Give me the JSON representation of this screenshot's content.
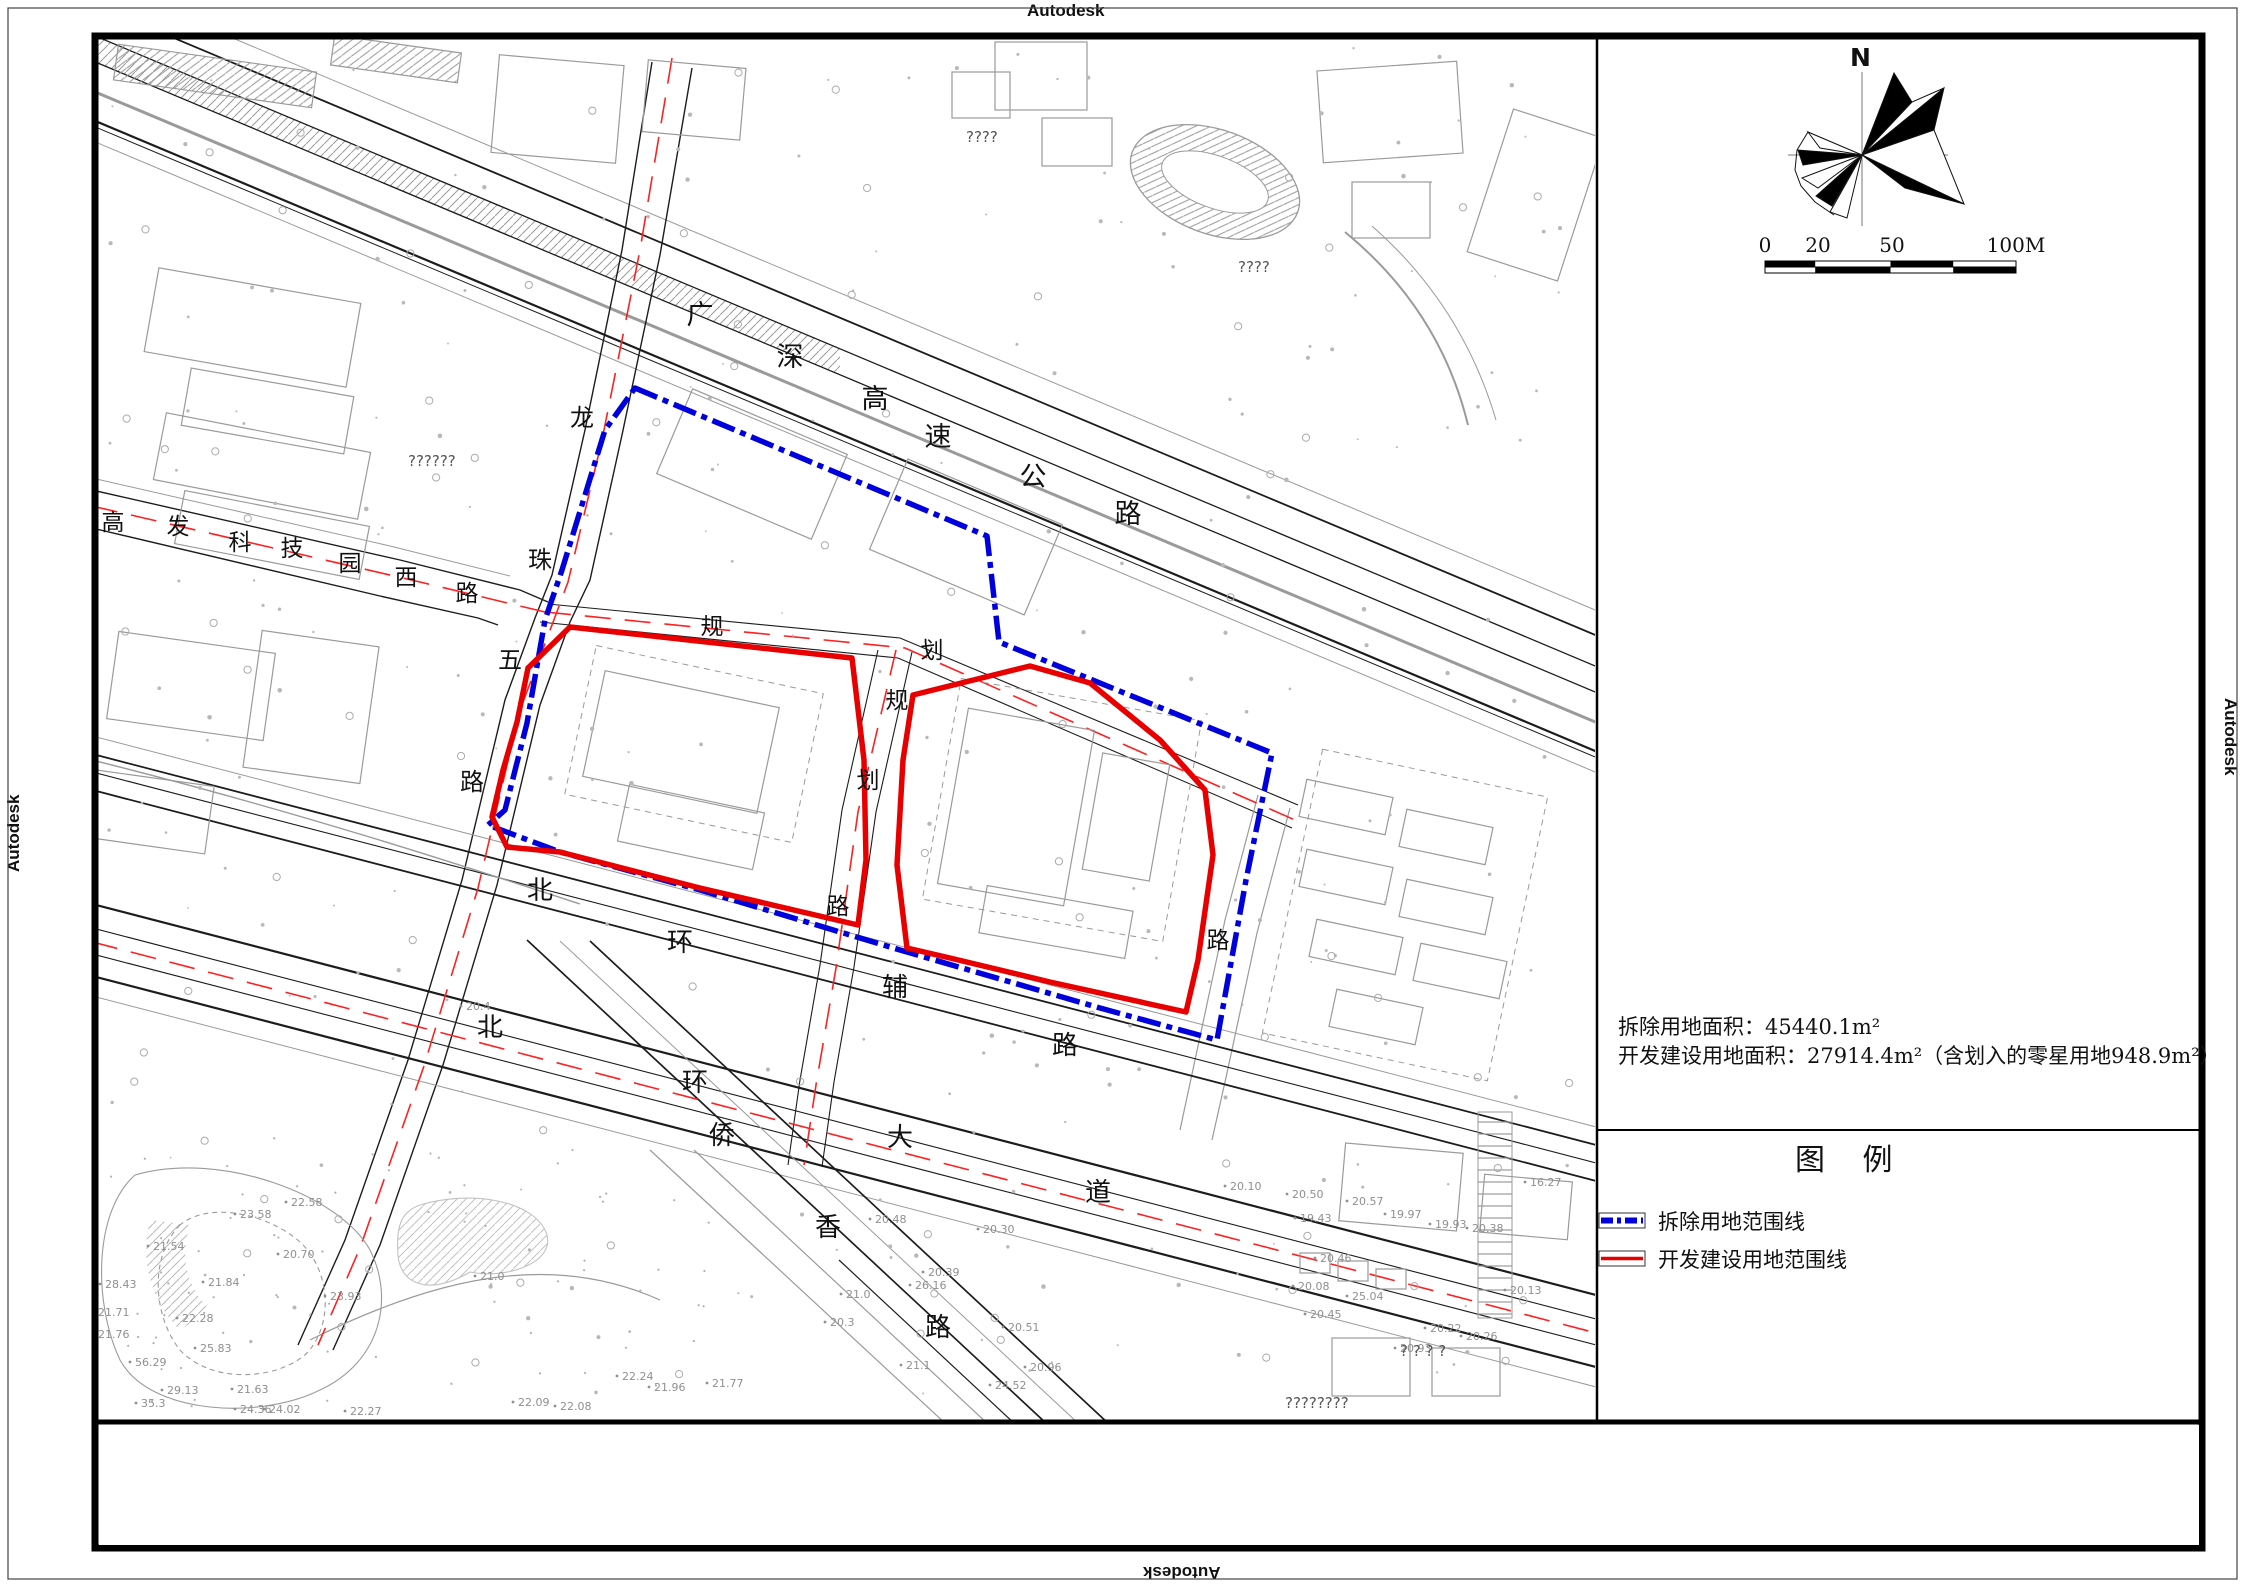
{
  "watermarks": {
    "top": "Autodesk",
    "bottom": "Autodesk",
    "left": "Autodesk",
    "right": "Autodesk"
  },
  "colors": {
    "demolition_blue": "#0000dd",
    "development_red": "#e80000",
    "centerline_red": "#ff2020",
    "road_dark": "#1c1c1c",
    "road_gray": "#9a9a9a"
  },
  "north_label": "N",
  "scale_bar": {
    "labels": [
      "0",
      "20",
      "50",
      "100M"
    ]
  },
  "notes": {
    "line1": "拆除用地面积：45440.1m²",
    "line2": "开发建设用地面积：27914.4m²（含划入的零星用地948.9m²）"
  },
  "legend": {
    "title": "图 例",
    "items": [
      {
        "label": "拆除用地范围线",
        "type": "demolition"
      },
      {
        "label": "开发建设用地范围线",
        "type": "development"
      }
    ]
  },
  "roads": [
    {
      "name": "广深高速公路",
      "size": 27,
      "chars": [
        {
          "t": "广",
          "x": 700,
          "y": 324
        },
        {
          "t": "深",
          "x": 790,
          "y": 366
        },
        {
          "t": "高",
          "x": 875,
          "y": 408
        },
        {
          "t": "速",
          "x": 938,
          "y": 446
        },
        {
          "t": "公",
          "x": 1033,
          "y": 486
        },
        {
          "t": "路",
          "x": 1128,
          "y": 523
        }
      ]
    },
    {
      "name": "高发科技园西路",
      "size": 23,
      "chars": [
        {
          "t": "高",
          "x": 113,
          "y": 530
        },
        {
          "t": "发",
          "x": 178,
          "y": 534
        },
        {
          "t": "科",
          "x": 240,
          "y": 550
        },
        {
          "t": "技",
          "x": 292,
          "y": 556
        },
        {
          "t": "园",
          "x": 350,
          "y": 571
        },
        {
          "t": "西",
          "x": 406,
          "y": 585
        },
        {
          "t": "路",
          "x": 467,
          "y": 601
        }
      ]
    },
    {
      "name": "龙珠五路",
      "size": 24,
      "chars": [
        {
          "t": "龙",
          "x": 582,
          "y": 426
        },
        {
          "t": "珠",
          "x": 540,
          "y": 568
        },
        {
          "t": "五",
          "x": 510,
          "y": 668
        },
        {
          "t": "路",
          "x": 472,
          "y": 790
        }
      ]
    },
    {
      "name": "规划",
      "size": 23,
      "chars": [
        {
          "t": "规",
          "x": 712,
          "y": 634
        },
        {
          "t": "划",
          "x": 932,
          "y": 658
        }
      ]
    },
    {
      "name": "规划路",
      "size": 23,
      "chars": [
        {
          "t": "规",
          "x": 897,
          "y": 708
        },
        {
          "t": "划",
          "x": 868,
          "y": 788
        },
        {
          "t": "路",
          "x": 838,
          "y": 914
        }
      ]
    },
    {
      "name": "路",
      "size": 23,
      "chars": [
        {
          "t": "路",
          "x": 1218,
          "y": 948
        }
      ]
    },
    {
      "name": "北环辅路",
      "size": 26,
      "chars": [
        {
          "t": "北",
          "x": 540,
          "y": 899
        },
        {
          "t": "环",
          "x": 680,
          "y": 951
        },
        {
          "t": "辅",
          "x": 895,
          "y": 996
        },
        {
          "t": "路",
          "x": 1065,
          "y": 1054
        }
      ]
    },
    {
      "name": "北环大道",
      "size": 26,
      "chars": [
        {
          "t": "北",
          "x": 490,
          "y": 1036
        },
        {
          "t": "环",
          "x": 695,
          "y": 1091
        },
        {
          "t": "大",
          "x": 900,
          "y": 1146
        },
        {
          "t": "道",
          "x": 1098,
          "y": 1201
        }
      ]
    },
    {
      "name": "侨香路",
      "size": 26,
      "chars": [
        {
          "t": "侨",
          "x": 722,
          "y": 1144
        },
        {
          "t": "香",
          "x": 828,
          "y": 1236
        },
        {
          "t": "路",
          "x": 938,
          "y": 1336
        }
      ]
    }
  ],
  "spot_elevations": [
    {
      "v": "20.48",
      "x": 875,
      "y": 1223
    },
    {
      "v": "20.30",
      "x": 983,
      "y": 1233
    },
    {
      "v": "20.39",
      "x": 928,
      "y": 1276
    },
    {
      "v": "26.16",
      "x": 915,
      "y": 1289
    },
    {
      "v": "21.0",
      "x": 846,
      "y": 1298
    },
    {
      "v": "20.51",
      "x": 1008,
      "y": 1331
    },
    {
      "v": "20.96",
      "x": 1030,
      "y": 1371
    },
    {
      "v": "24.52",
      "x": 995,
      "y": 1389
    },
    {
      "v": "21.1",
      "x": 906,
      "y": 1369
    },
    {
      "v": "20.3",
      "x": 830,
      "y": 1326
    },
    {
      "v": "29.13",
      "x": 167,
      "y": 1394
    },
    {
      "v": "35.3",
      "x": 141,
      "y": 1407
    },
    {
      "v": "21.63",
      "x": 237,
      "y": 1393
    },
    {
      "v": "24.36",
      "x": 240,
      "y": 1413
    },
    {
      "v": "24.02",
      "x": 269,
      "y": 1413
    },
    {
      "v": "22.27",
      "x": 350,
      "y": 1415
    },
    {
      "v": "22.09",
      "x": 518,
      "y": 1406
    },
    {
      "v": "22.08",
      "x": 560,
      "y": 1410
    },
    {
      "v": "21.96",
      "x": 654,
      "y": 1391
    },
    {
      "v": "21.77",
      "x": 712,
      "y": 1387
    },
    {
      "v": "22.24",
      "x": 622,
      "y": 1380
    },
    {
      "v": "23.58",
      "x": 240,
      "y": 1218
    },
    {
      "v": "22.58",
      "x": 291,
      "y": 1206
    },
    {
      "v": "21.54",
      "x": 153,
      "y": 1250
    },
    {
      "v": "20.70",
      "x": 283,
      "y": 1258
    },
    {
      "v": "21.84",
      "x": 208,
      "y": 1286
    },
    {
      "v": "28.43",
      "x": 105,
      "y": 1288
    },
    {
      "v": "21.71",
      "x": 98,
      "y": 1316
    },
    {
      "v": "22.28",
      "x": 182,
      "y": 1322
    },
    {
      "v": "21.76",
      "x": 98,
      "y": 1338
    },
    {
      "v": "25.83",
      "x": 200,
      "y": 1352
    },
    {
      "v": "56.29",
      "x": 135,
      "y": 1366
    },
    {
      "v": "23.93",
      "x": 330,
      "y": 1300
    },
    {
      "v": "20.10",
      "x": 1230,
      "y": 1190
    },
    {
      "v": "20.50",
      "x": 1292,
      "y": 1198
    },
    {
      "v": "20.57",
      "x": 1352,
      "y": 1205
    },
    {
      "v": "19.43",
      "x": 1300,
      "y": 1222
    },
    {
      "v": "19.97",
      "x": 1390,
      "y": 1218
    },
    {
      "v": "19.93",
      "x": 1435,
      "y": 1228
    },
    {
      "v": "20.38",
      "x": 1472,
      "y": 1232
    },
    {
      "v": "16.27",
      "x": 1530,
      "y": 1186
    },
    {
      "v": "20.46",
      "x": 1320,
      "y": 1262
    },
    {
      "v": "20.08",
      "x": 1298,
      "y": 1290
    },
    {
      "v": "25.04",
      "x": 1352,
      "y": 1300
    },
    {
      "v": "20.45",
      "x": 1310,
      "y": 1318
    },
    {
      "v": "20.22",
      "x": 1430,
      "y": 1332
    },
    {
      "v": "20.93",
      "x": 1400,
      "y": 1352
    },
    {
      "v": "20.26",
      "x": 1466,
      "y": 1340
    },
    {
      "v": "21.0",
      "x": 480,
      "y": 1280
    },
    {
      "v": "20.4",
      "x": 466,
      "y": 1010
    },
    {
      "v": "20.13",
      "x": 1510,
      "y": 1294
    }
  ],
  "glyph_placeholders": [
    {
      "t": "????",
      "x": 966,
      "y": 142
    },
    {
      "t": "????",
      "x": 1238,
      "y": 272
    },
    {
      "t": "??????",
      "x": 408,
      "y": 466
    },
    {
      "t": "? ? ? ?",
      "x": 1400,
      "y": 1356
    },
    {
      "t": "????????",
      "x": 1285,
      "y": 1408
    }
  ]
}
